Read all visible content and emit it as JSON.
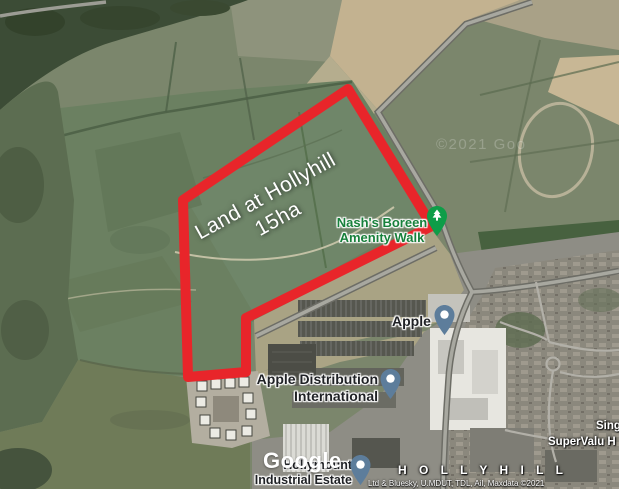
{
  "map": {
    "parcel_label": {
      "line1": "Land at Hollyhill",
      "line2": "15ha"
    },
    "pois": {
      "amenity": {
        "line1": "Nash's Boreen",
        "line2": "Amenity Walk"
      },
      "apple": {
        "name": "Apple"
      },
      "apple_distribution": {
        "line1": "Apple Distribution",
        "line2": "International"
      },
      "hollymount": {
        "line1": "Hollymount",
        "line2": "Industrial Estate"
      },
      "district": "H O L L Y H I L L",
      "singers": "Sing",
      "supervalu": "SuperValu H"
    },
    "watermarks": {
      "logo": "Google",
      "tile": "©2021 Goo"
    },
    "attribution": "Ltd & Bluesky, U.MDUT, TDL, Ail, Maxdata ©2021",
    "colors": {
      "parcel_outline": "#e8252a",
      "amenity_green": "#17803b",
      "pin_blue": "#5d7d9b",
      "pin_blue_edge": "#43607a",
      "pin_green": "#0e9d48"
    }
  }
}
